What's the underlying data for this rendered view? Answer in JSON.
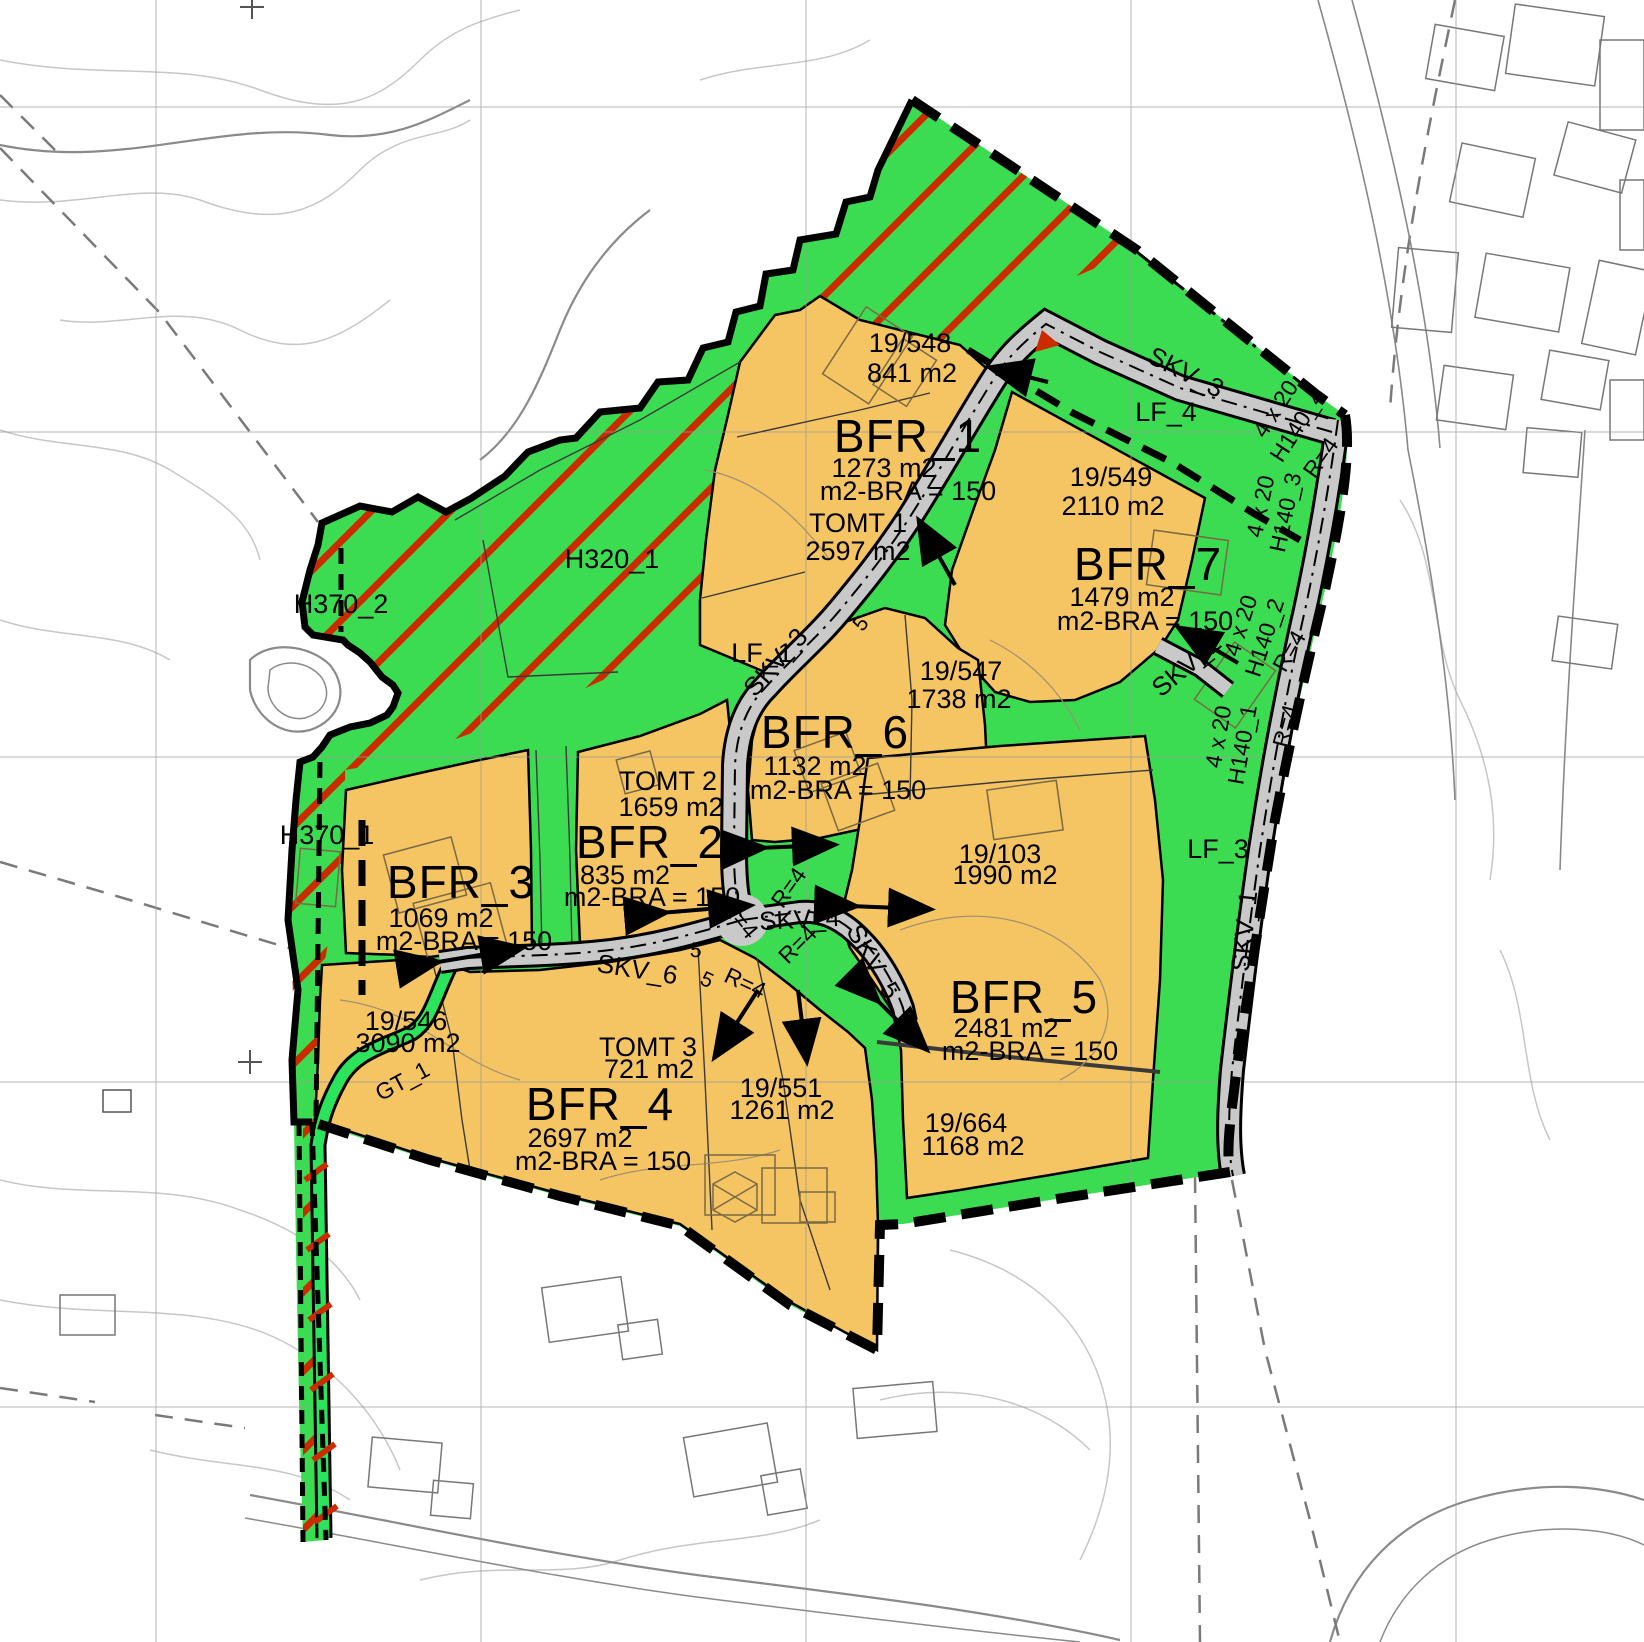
{
  "zones": [
    {
      "label": "BFR_1",
      "area": "1273 m2",
      "bra": "m2-BRA = 150"
    },
    {
      "label": "BFR_2",
      "area": "835 m2",
      "bra": "m2-BRA = 150"
    },
    {
      "label": "BFR_3",
      "area": "1069 m2",
      "bra": "m2-BRA = 150"
    },
    {
      "label": "BFR_4",
      "area": "2697 m2",
      "bra": "m2-BRA = 150"
    },
    {
      "label": "BFR_5",
      "area": "2481 m2",
      "bra": "m2-BRA = 150"
    },
    {
      "label": "BFR_6",
      "area": "1132 m2",
      "bra": "m2-BRA = 150"
    },
    {
      "label": "BFR_7",
      "area": "1479 m2",
      "bra": "m2-BRA = 150"
    }
  ],
  "parcels": [
    {
      "id": "19/548",
      "area": "841 m2"
    },
    {
      "id": "19/549",
      "area": "2110 m2"
    },
    {
      "id": "19/547",
      "area": "1738 m2"
    },
    {
      "id": "19/103",
      "area": "1990 m2"
    },
    {
      "id": "19/546",
      "area": "3090 m2"
    },
    {
      "id": "19/551",
      "area": "1261 m2"
    },
    {
      "id": "19/664",
      "area": "1168 m2"
    }
  ],
  "lots": [
    {
      "label": "TOMT 1",
      "area": "2597 m2"
    },
    {
      "label": "TOMT 2",
      "area": "1659 m2"
    },
    {
      "label": "TOMT 3",
      "area": "721 m2"
    }
  ],
  "roads": {
    "skv1": "SKV_1",
    "skv2": "SKV_2",
    "skv3": "SKV_3",
    "skv4": "SKV_4",
    "skv5": "SKV_5",
    "skv6": "SKV_6"
  },
  "walkway": {
    "gt1": "GT_1"
  },
  "green_areas": {
    "lf1": "LF_1",
    "lf3": "LF_3",
    "lf4": "LF_4"
  },
  "hazard_zones": {
    "h320_1": "H320_1",
    "h370_1": "H370_1",
    "h370_2": "H370_2"
  },
  "sight_zones": {
    "dim": "4 x 20",
    "h140_1": "H140_1",
    "h140_2": "H140_2",
    "h140_3": "H140_3",
    "h140_4": "H140_4"
  },
  "annotations": {
    "radius": "R=4",
    "road_width": "5"
  },
  "colors": {
    "residential": "#f5c463",
    "green": "#3bdc51",
    "walkway_green": "#2be45c",
    "hatch_red": "#cc2b00",
    "road_gray": "#c9c9c9",
    "boundary_black": "#000000"
  }
}
